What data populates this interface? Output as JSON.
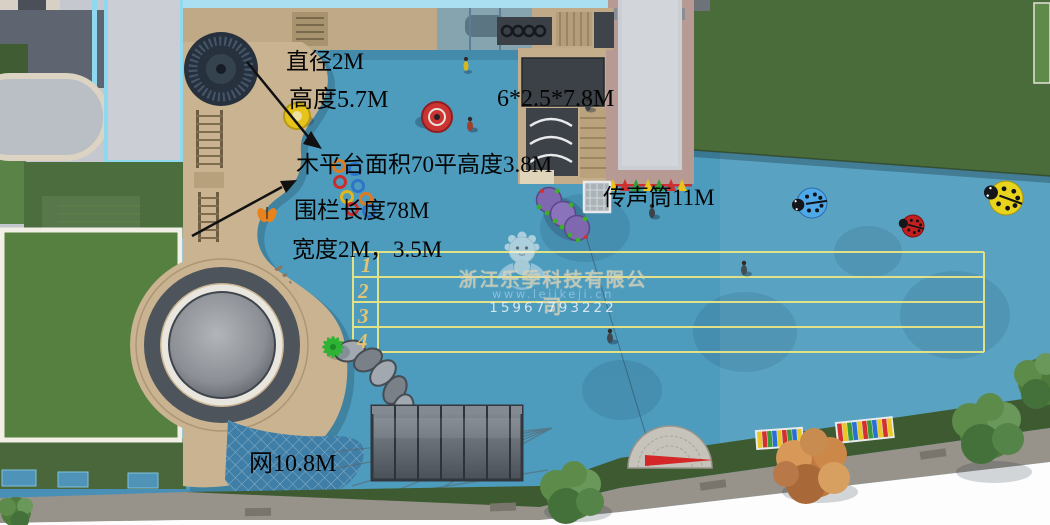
{
  "annotations": {
    "diameter": "直径2M",
    "height": "高度5.7M",
    "structure_size": "6*2.5*7.8M",
    "platform": "木平台面积70平高度3.8M",
    "fence": "围栏长度78M",
    "width": "宽度2M，3.5M",
    "voice_tube": "传声筒11M",
    "net": "网10.8M"
  },
  "track": {
    "lane_numbers": [
      "1",
      "2",
      "3",
      "4"
    ]
  },
  "watermark": {
    "company": "浙江乐季科技有限公司",
    "website": "www.lejikeji.cn",
    "phone": "15967793222"
  },
  "colors": {
    "playground_blue": "#4d9bbd",
    "lawn_green_dark": "#4a6c3a",
    "lawn_green_light": "#55803f",
    "deck_tan": "#c9b390",
    "track_line_yellow": "#e9e586",
    "building_wall_pink": "#b79a93",
    "canopy_cyan": "#a9dff0",
    "annotation_text": "#050505"
  }
}
